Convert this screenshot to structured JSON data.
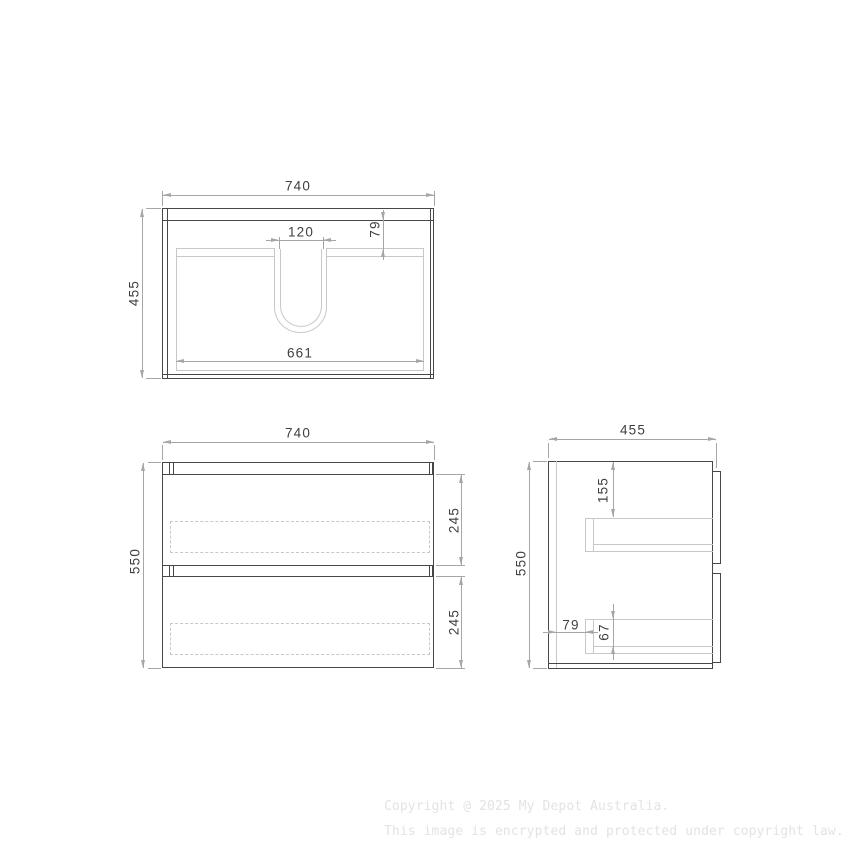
{
  "views": {
    "top": {
      "width": "740",
      "height": "455",
      "basin_width": "120",
      "basin_depth": "79",
      "inner_width": "661"
    },
    "front": {
      "width": "740",
      "height": "550",
      "drawer_top_height": "245",
      "drawer_bottom_height": "245"
    },
    "side": {
      "depth": "455",
      "height": "550",
      "top_to_drawer": "155",
      "wall_to_drawer": "79",
      "drawer_inner_height": "67"
    }
  },
  "watermark": {
    "line1": "Copyright @ 2025 My Depot Australia.",
    "line2": "This image is encrypted and protected under copyright law."
  },
  "colors": {
    "background": "#ffffff",
    "outline_dark": "#474747",
    "outline_light": "#c8c8c8",
    "dimension": "#a6a6a6",
    "dimension_text": "#3f3f3f",
    "watermark": "#e3e3e3"
  }
}
